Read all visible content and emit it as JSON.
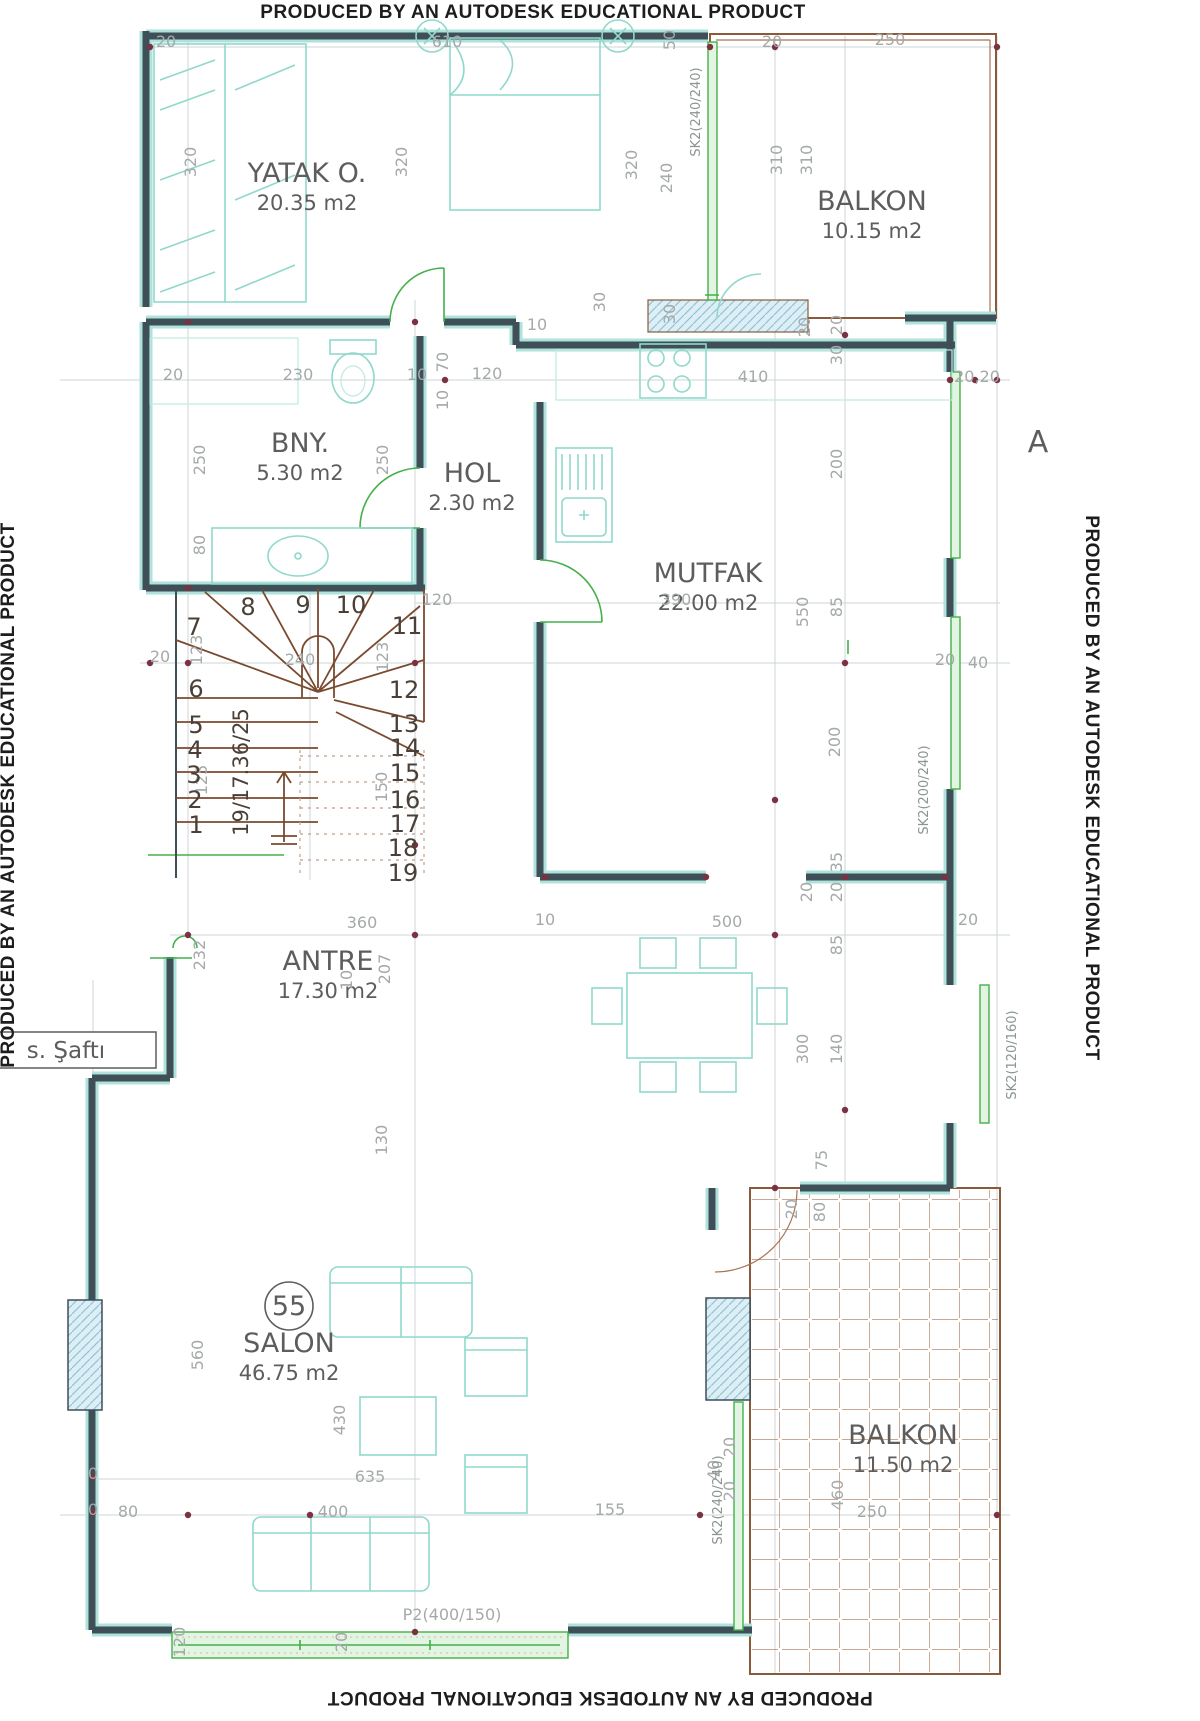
{
  "banner": {
    "text": "PRODUCED BY AN AUTODESK EDUCATIONAL PRODUCT"
  },
  "labels": {
    "section_a": "A",
    "shaft": "s. Şaftı",
    "door_code": "P2(400/150)",
    "unit_number": "55"
  },
  "rooms": [
    {
      "name": "YATAK O.",
      "area": "20.35 m2",
      "x": 307,
      "y": 182
    },
    {
      "name": "BALKON",
      "area": "10.15 m2",
      "x": 872,
      "y": 210
    },
    {
      "name": "BNY.",
      "area": "5.30 m2",
      "x": 300,
      "y": 452
    },
    {
      "name": "HOL",
      "area": "2.30 m2",
      "x": 472,
      "y": 482
    },
    {
      "name": "MUTFAK",
      "area": "22.00 m2",
      "x": 708,
      "y": 582
    },
    {
      "name": "ANTRE",
      "area": "17.30 m2",
      "x": 328,
      "y": 970
    },
    {
      "name": "SALON",
      "area": "46.75 m2",
      "x": 289,
      "y": 1352
    },
    {
      "name": "BALKON",
      "area": "11.50 m2",
      "x": 903,
      "y": 1444
    }
  ],
  "stairs": {
    "note": "19/17.36/25",
    "note_x": 248,
    "note_y": 772,
    "steps": [
      {
        "t": "1",
        "x": 196,
        "y": 833
      },
      {
        "t": "2",
        "x": 195,
        "y": 808
      },
      {
        "t": "3",
        "x": 194,
        "y": 783
      },
      {
        "t": "4",
        "x": 195,
        "y": 758
      },
      {
        "t": "5",
        "x": 196,
        "y": 733
      },
      {
        "t": "6",
        "x": 196,
        "y": 697
      },
      {
        "t": "7",
        "x": 194,
        "y": 635
      },
      {
        "t": "8",
        "x": 248,
        "y": 615
      },
      {
        "t": "9",
        "x": 303,
        "y": 613
      },
      {
        "t": "10",
        "x": 351,
        "y": 613
      },
      {
        "t": "11",
        "x": 407,
        "y": 634
      },
      {
        "t": "12",
        "x": 404,
        "y": 698
      },
      {
        "t": "13",
        "x": 404,
        "y": 732
      },
      {
        "t": "14",
        "x": 405,
        "y": 756
      },
      {
        "t": "15",
        "x": 405,
        "y": 781
      },
      {
        "t": "16",
        "x": 405,
        "y": 808
      },
      {
        "t": "17",
        "x": 405,
        "y": 832
      },
      {
        "t": "18",
        "x": 403,
        "y": 856
      },
      {
        "t": "19",
        "x": 403,
        "y": 881
      }
    ]
  },
  "windows": [
    {
      "code": "SK2(240/240)",
      "x": 700,
      "y": 112,
      "r": -90
    },
    {
      "code": "SK2(200/240)",
      "x": 928,
      "y": 790,
      "r": -90
    },
    {
      "code": "SK2(120/160)",
      "x": 1016,
      "y": 1055,
      "r": -90
    },
    {
      "code": "SK2(240/240)",
      "x": 722,
      "y": 1500,
      "r": -90
    }
  ],
  "dimensions": [
    {
      "t": "20",
      "x": 166,
      "y": 47
    },
    {
      "t": "610",
      "x": 447,
      "y": 47
    },
    {
      "t": "20",
      "x": 772,
      "y": 47
    },
    {
      "t": "250",
      "x": 890,
      "y": 45
    },
    {
      "t": "50",
      "x": 675,
      "y": 40,
      "r": -90
    },
    {
      "t": "320",
      "x": 196,
      "y": 162,
      "r": -90
    },
    {
      "t": "320",
      "x": 407,
      "y": 162,
      "r": -90
    },
    {
      "t": "320",
      "x": 637,
      "y": 165,
      "r": -90
    },
    {
      "t": "240",
      "x": 672,
      "y": 178,
      "r": -90
    },
    {
      "t": "310",
      "x": 782,
      "y": 160,
      "r": -90
    },
    {
      "t": "310",
      "x": 812,
      "y": 160,
      "r": -90
    },
    {
      "t": "30",
      "x": 605,
      "y": 302,
      "r": -90
    },
    {
      "t": "30",
      "x": 675,
      "y": 314,
      "r": -90
    },
    {
      "t": "10",
      "x": 537,
      "y": 330
    },
    {
      "t": "20",
      "x": 810,
      "y": 327,
      "r": -90
    },
    {
      "t": "20",
      "x": 842,
      "y": 325,
      "r": -90
    },
    {
      "t": "30",
      "x": 842,
      "y": 355,
      "r": -90
    },
    {
      "t": "20",
      "x": 173,
      "y": 380
    },
    {
      "t": "230",
      "x": 298,
      "y": 380
    },
    {
      "t": "10",
      "x": 417,
      "y": 380
    },
    {
      "t": "120",
      "x": 487,
      "y": 379
    },
    {
      "t": "410",
      "x": 753,
      "y": 382
    },
    {
      "t": "70",
      "x": 448,
      "y": 362,
      "r": -90
    },
    {
      "t": "10",
      "x": 448,
      "y": 400,
      "r": -90
    },
    {
      "t": "20,20",
      "x": 977,
      "y": 382
    },
    {
      "t": "250",
      "x": 205,
      "y": 460,
      "r": -90
    },
    {
      "t": "250",
      "x": 388,
      "y": 460,
      "r": -90
    },
    {
      "t": "80",
      "x": 205,
      "y": 545,
      "r": -90
    },
    {
      "t": "200",
      "x": 842,
      "y": 464,
      "r": -90
    },
    {
      "t": "550",
      "x": 808,
      "y": 612,
      "r": -90
    },
    {
      "t": "85",
      "x": 842,
      "y": 607,
      "r": -90
    },
    {
      "t": "20",
      "x": 160,
      "y": 662
    },
    {
      "t": "123",
      "x": 202,
      "y": 650,
      "r": -90
    },
    {
      "t": "240",
      "x": 300,
      "y": 665
    },
    {
      "t": "123",
      "x": 388,
      "y": 657,
      "r": -90
    },
    {
      "t": "120",
      "x": 437,
      "y": 605
    },
    {
      "t": "390",
      "x": 676,
      "y": 605
    },
    {
      "t": "20",
      "x": 945,
      "y": 665
    },
    {
      "t": "40",
      "x": 978,
      "y": 668
    },
    {
      "t": "125",
      "x": 207,
      "y": 780,
      "r": -90
    },
    {
      "t": "150",
      "x": 387,
      "y": 787,
      "r": -90
    },
    {
      "t": "200",
      "x": 840,
      "y": 742,
      "r": -90
    },
    {
      "t": "35",
      "x": 842,
      "y": 862,
      "r": -90
    },
    {
      "t": "20",
      "x": 812,
      "y": 892,
      "r": -90
    },
    {
      "t": "20",
      "x": 842,
      "y": 892,
      "r": -90
    },
    {
      "t": "85",
      "x": 842,
      "y": 945,
      "r": -90
    },
    {
      "t": "500",
      "x": 727,
      "y": 927
    },
    {
      "t": "10",
      "x": 545,
      "y": 925
    },
    {
      "t": "360",
      "x": 362,
      "y": 928
    },
    {
      "t": "232",
      "x": 205,
      "y": 955,
      "r": -90
    },
    {
      "t": "207",
      "x": 390,
      "y": 969,
      "r": -90
    },
    {
      "t": "300",
      "x": 808,
      "y": 1049,
      "r": -90
    },
    {
      "t": "140",
      "x": 842,
      "y": 1049,
      "r": -90
    },
    {
      "t": "20",
      "x": 968,
      "y": 925
    },
    {
      "t": "10",
      "x": 352,
      "y": 980,
      "r": -90
    },
    {
      "t": "130",
      "x": 387,
      "y": 1140,
      "r": -90
    },
    {
      "t": "75",
      "x": 827,
      "y": 1160,
      "r": -90
    },
    {
      "t": "20",
      "x": 797,
      "y": 1209,
      "r": -90
    },
    {
      "t": "80",
      "x": 825,
      "y": 1212,
      "r": -90
    },
    {
      "t": "560",
      "x": 203,
      "y": 1355,
      "r": -90
    },
    {
      "t": "430",
      "x": 345,
      "y": 1420,
      "r": -90
    },
    {
      "t": "635",
      "x": 370,
      "y": 1482
    },
    {
      "t": "0",
      "x": 93,
      "y": 1479
    },
    {
      "t": "0",
      "x": 93,
      "y": 1515
    },
    {
      "t": "80",
      "x": 128,
      "y": 1517
    },
    {
      "t": "400",
      "x": 333,
      "y": 1517
    },
    {
      "t": "155",
      "x": 610,
      "y": 1515
    },
    {
      "t": "20",
      "x": 735,
      "y": 1447,
      "r": -90
    },
    {
      "t": "40",
      "x": 719,
      "y": 1470,
      "r": -90
    },
    {
      "t": "20",
      "x": 735,
      "y": 1491,
      "r": -90
    },
    {
      "t": "460",
      "x": 843,
      "y": 1495,
      "r": -90
    },
    {
      "t": "250",
      "x": 872,
      "y": 1517
    },
    {
      "t": "120",
      "x": 185,
      "y": 1642,
      "r": -90
    },
    {
      "t": "20",
      "x": 347,
      "y": 1642,
      "r": -90
    }
  ],
  "colors": {
    "wall": "#3e4f58",
    "wall_accent": "#aee2da",
    "furniture": "#8fd8cb",
    "window_green": "#44b04a",
    "balcony_brown": "#8a5a3a",
    "dimension_gray": "#a5a9a9",
    "marker_red": "#7a3242",
    "text_gray": "#5d5d5d"
  }
}
